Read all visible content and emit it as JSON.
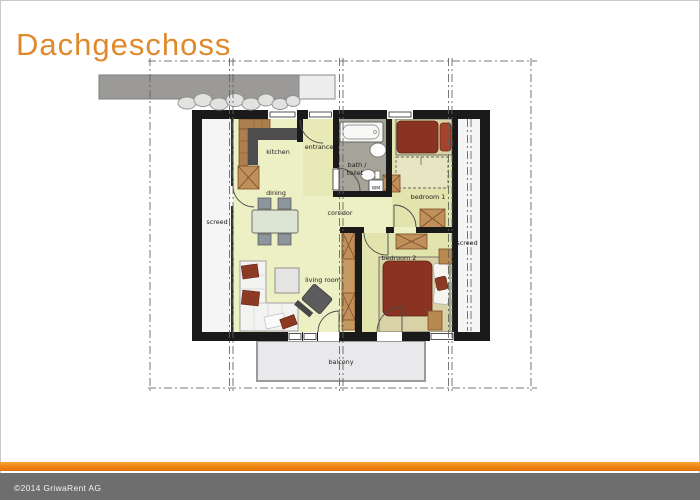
{
  "page": {
    "title": "Dachgeschoss",
    "footer_copyright": "©2014 GriwaRent AG"
  },
  "floor_plan": {
    "labels": {
      "kitchen": "kitchen",
      "entrance": "entrance",
      "bath_line1": "bath /",
      "bath_line2": "toilet",
      "washing_machine": "WM",
      "bedroom1": "bedroom 1",
      "bedroom2": "bedroom 2",
      "dining": "dining",
      "corridor": "corridor",
      "living_room": "living room",
      "screed_left": "screed",
      "screed_right": "screed",
      "balcony": "balcony"
    }
  },
  "colors": {
    "title_orange": "#E1892D",
    "footer_bar_orange": "#EE8312",
    "footer_band_gray": "#6E6E6E",
    "wall_black": "#1A1A1A",
    "floor_main": "#EDEFC4",
    "floor_entrance": "#E7E9B6",
    "floor_bedroom": "#E2E4AE",
    "floor_bath": "#A6A398",
    "floor_screed": "#F5F5F5",
    "balcony_gray": "#E9E9EB",
    "bed_red": "#8A3322",
    "cabinet_wood": "#C1905A",
    "roof_band_gray": "#9C9A99"
  }
}
